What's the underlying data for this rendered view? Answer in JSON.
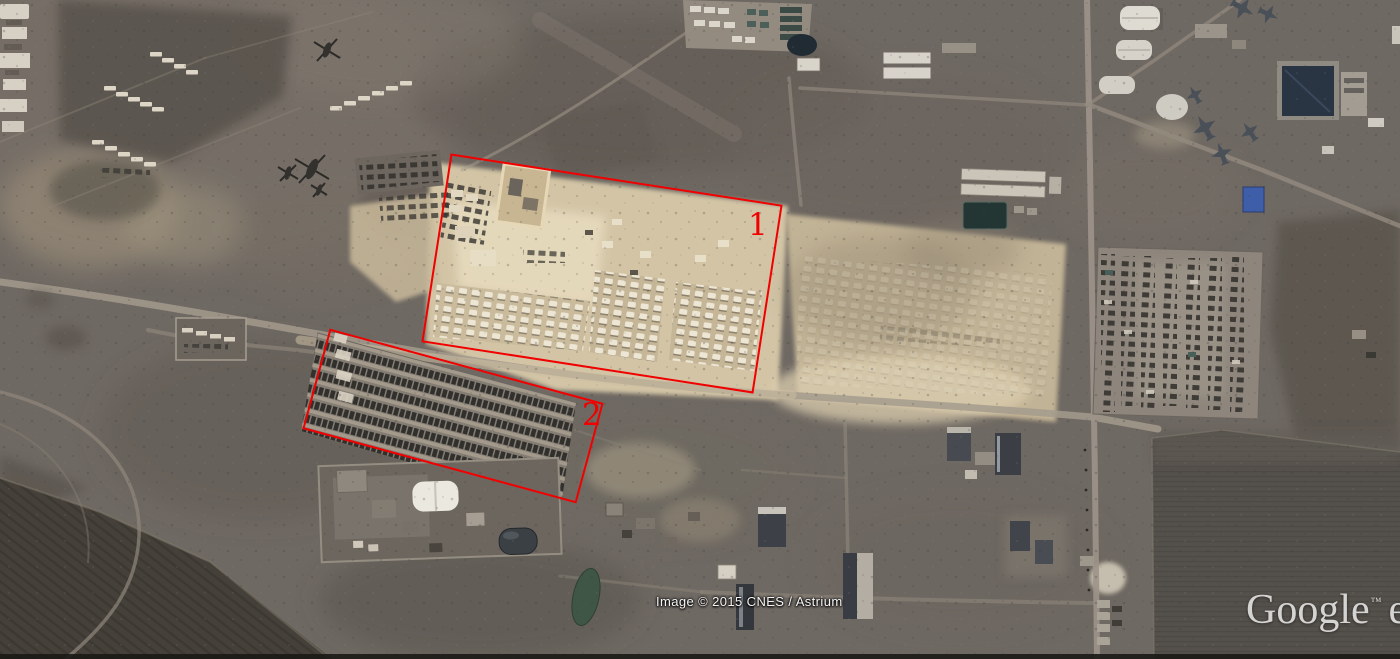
{
  "map": {
    "provider_attribution": "Image © 2015 CNES / Astrium",
    "watermark_brand": "Google",
    "watermark_trademark": "™",
    "watermark_clipped_suffix": "e"
  },
  "annotations": {
    "region1": {
      "label": "1",
      "box": {
        "left": 434,
        "top": 178,
        "width": 336,
        "height": 191,
        "rotation_deg": 8.8
      },
      "label_pos": {
        "left": 748,
        "top": 210
      }
    },
    "region2": {
      "label": "2",
      "box": {
        "left": 311,
        "top": 364,
        "width": 284,
        "height": 104,
        "rotation_deg": 15.2
      },
      "label_pos": {
        "left": 582,
        "top": 400
      }
    }
  },
  "colors": {
    "annotation": "#f10000",
    "attribution_text": "#f5f5f5",
    "watermark_text": "#ececec",
    "terrain_base": "#6f6963",
    "sand_light": "#d2c4a5",
    "field_dark": "#454039"
  }
}
